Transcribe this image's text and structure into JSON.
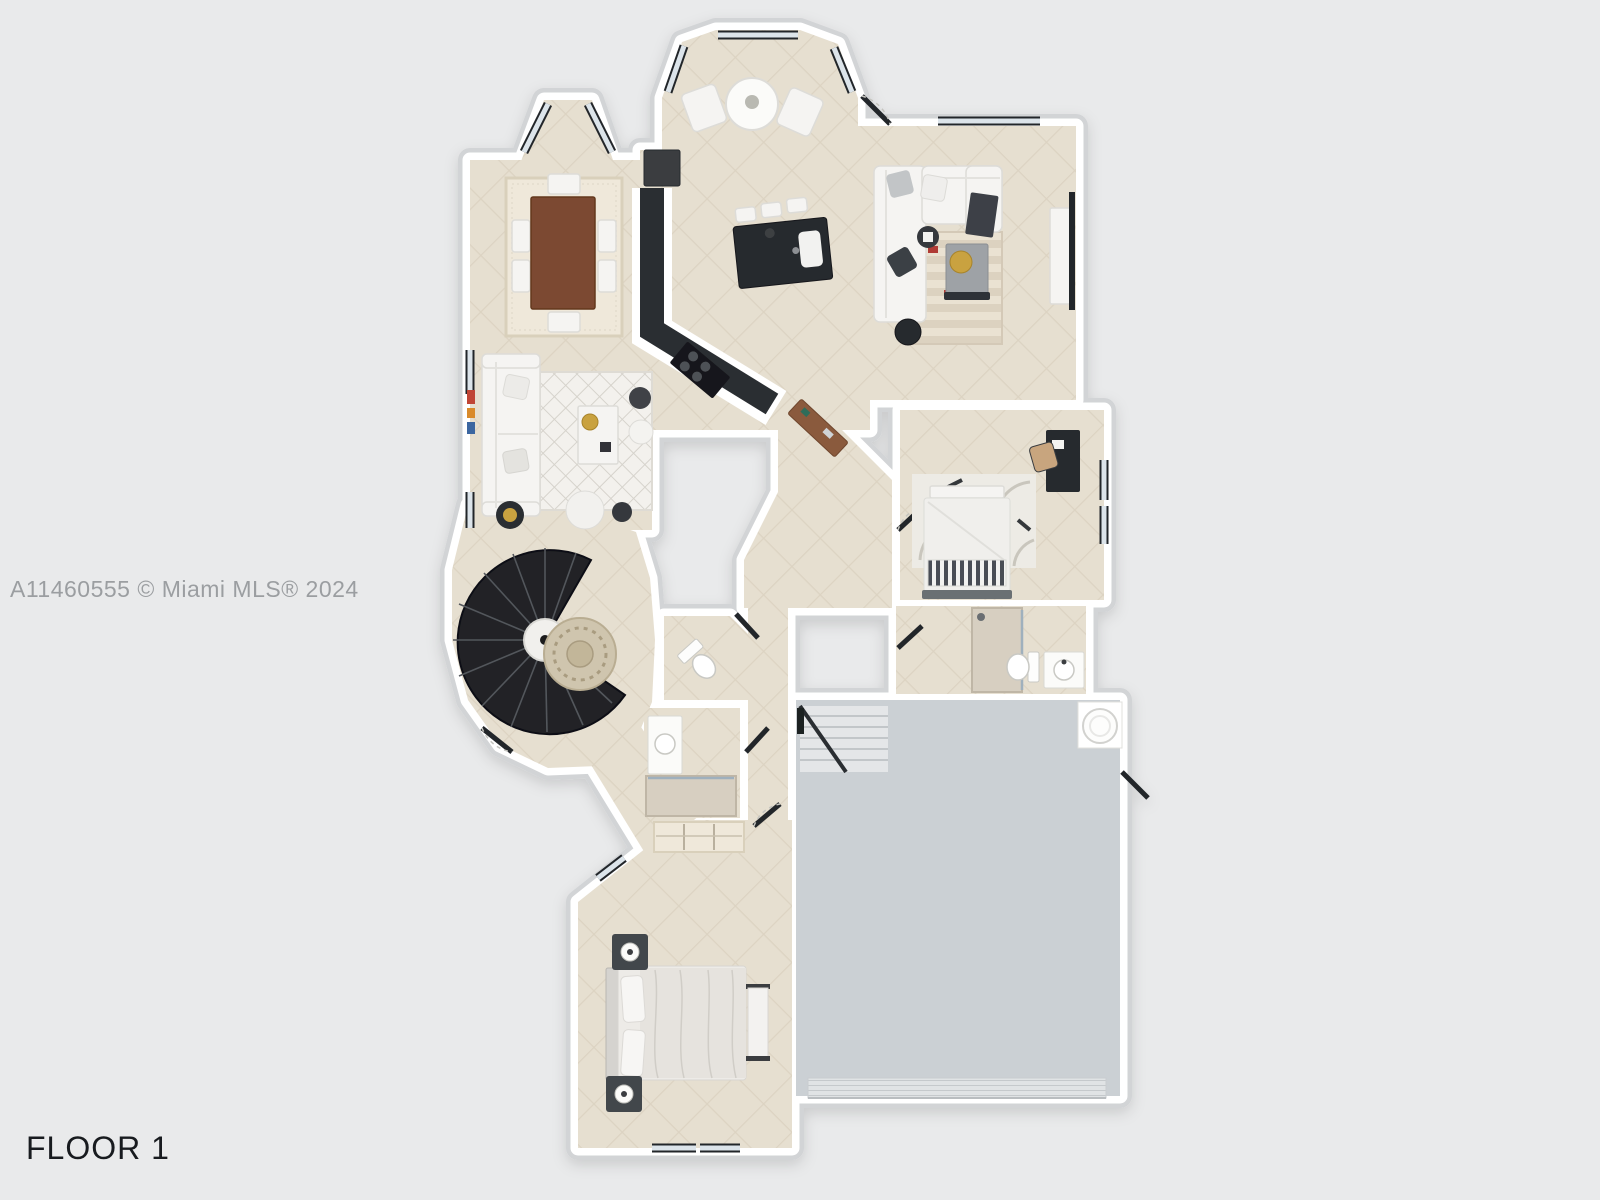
{
  "watermark": {
    "text": "A11460555 © Miami MLS® 2024"
  },
  "floor_label": {
    "text": "FLOOR 1"
  },
  "colors": {
    "background": "#e9eaeb",
    "wall": "#ffffff",
    "wall_shadow": "#d2d4d6",
    "floor_tile": "#e6dfd0",
    "tile_line": "#dcd3c2",
    "garage_floor": "#cbd0d4",
    "dark_accent": "#26292d",
    "wood_table": "#7b4a31",
    "console_wood": "#8a5a3c",
    "window_glass": "#dce4ea",
    "window_frame": "#24272b",
    "accent_gold": "#c9a23f",
    "watermark_text": "#9b9ea1",
    "label_text": "#181b1f"
  }
}
